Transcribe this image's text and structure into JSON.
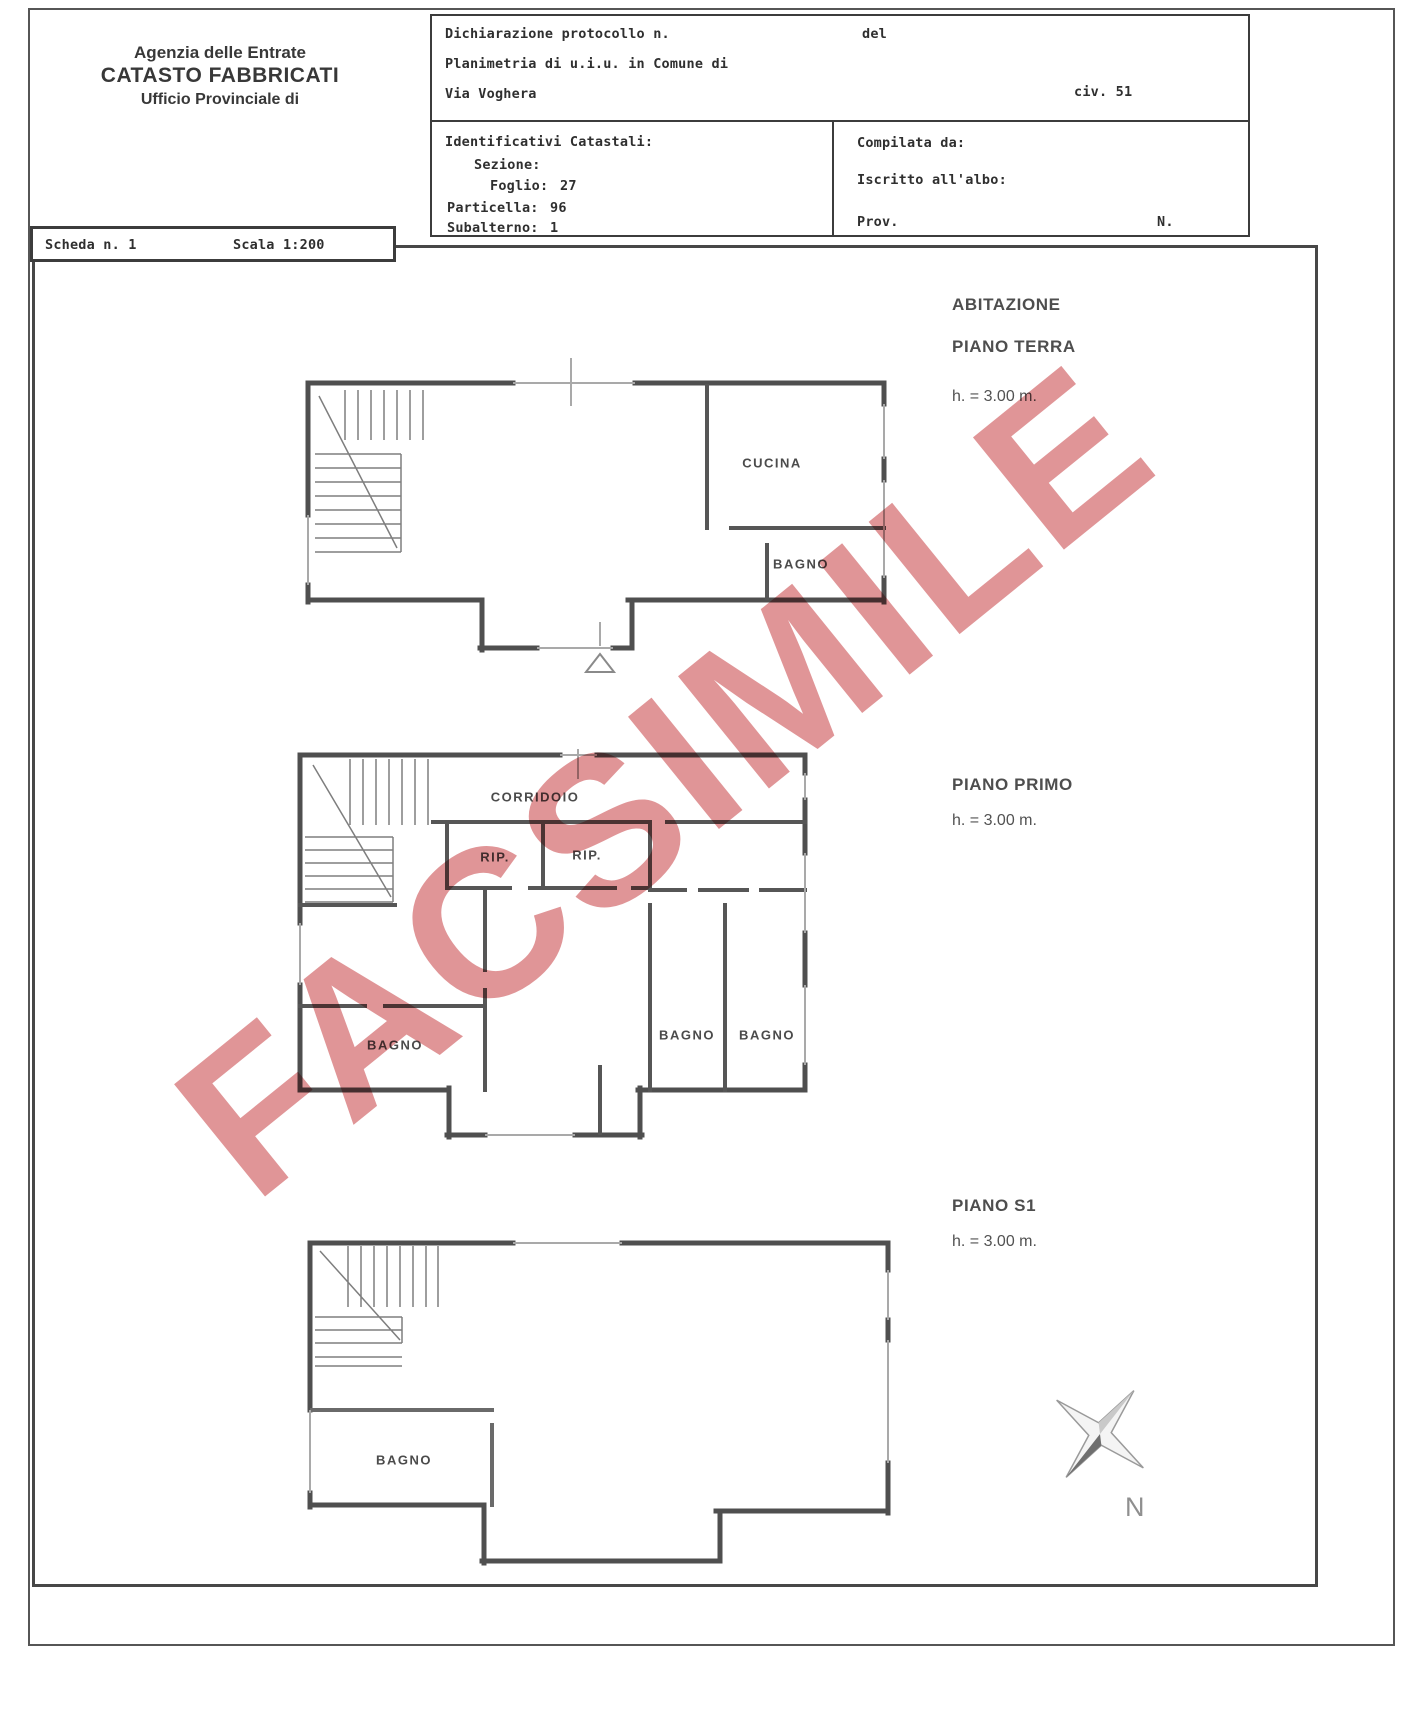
{
  "header": {
    "line1": "Agenzia delle Entrate",
    "line2": "CATASTO FABBRICATI",
    "line3": "Ufficio Provinciale di"
  },
  "form": {
    "dichiarazione_label": "Dichiarazione protocollo n.",
    "del_label": "del",
    "planimetria_label": "Planimetria di u.i.u. in Comune di",
    "via_value": "Via Voghera",
    "civ_value": "civ. 51",
    "identificativi_label": "Identificativi Catastali:",
    "sezione_label": "Sezione:",
    "foglio_label": "Foglio:",
    "foglio_value": "27",
    "particella_label": "Particella:",
    "particella_value": "96",
    "subalterno_label": "Subalterno:",
    "subalterno_value": "1",
    "compilata_label": "Compilata da:",
    "iscritto_label": "Iscritto all'albo:",
    "prov_label": "Prov.",
    "n_label": "N."
  },
  "scheda": {
    "scheda_label": "Scheda n. 1",
    "scala_label": "Scala 1:200"
  },
  "plans": {
    "ground": {
      "title1": "ABITAZIONE",
      "title2": "PIANO TERRA",
      "height": "h. = 3.00 m.",
      "rooms": {
        "cucina": "CUCINA",
        "bagno": "BAGNO"
      }
    },
    "first": {
      "title": "PIANO PRIMO",
      "height": "h. = 3.00 m.",
      "rooms": {
        "corridoio": "CORRIDOIO",
        "rip1": "RIP.",
        "rip2": "RIP.",
        "bagno_left": "BAGNO",
        "bagno_mid": "BAGNO",
        "bagno_right": "BAGNO"
      }
    },
    "s1": {
      "title": "PIANO S1",
      "height": "h. = 3.00 m.",
      "rooms": {
        "bagno": "BAGNO"
      }
    }
  },
  "watermark_text": "FACSIMILE",
  "compass": {
    "north_label": "N"
  },
  "colors": {
    "watermark": "#d97e80",
    "wall": "#4f4f4f",
    "window_line": "#a9a9a9"
  }
}
